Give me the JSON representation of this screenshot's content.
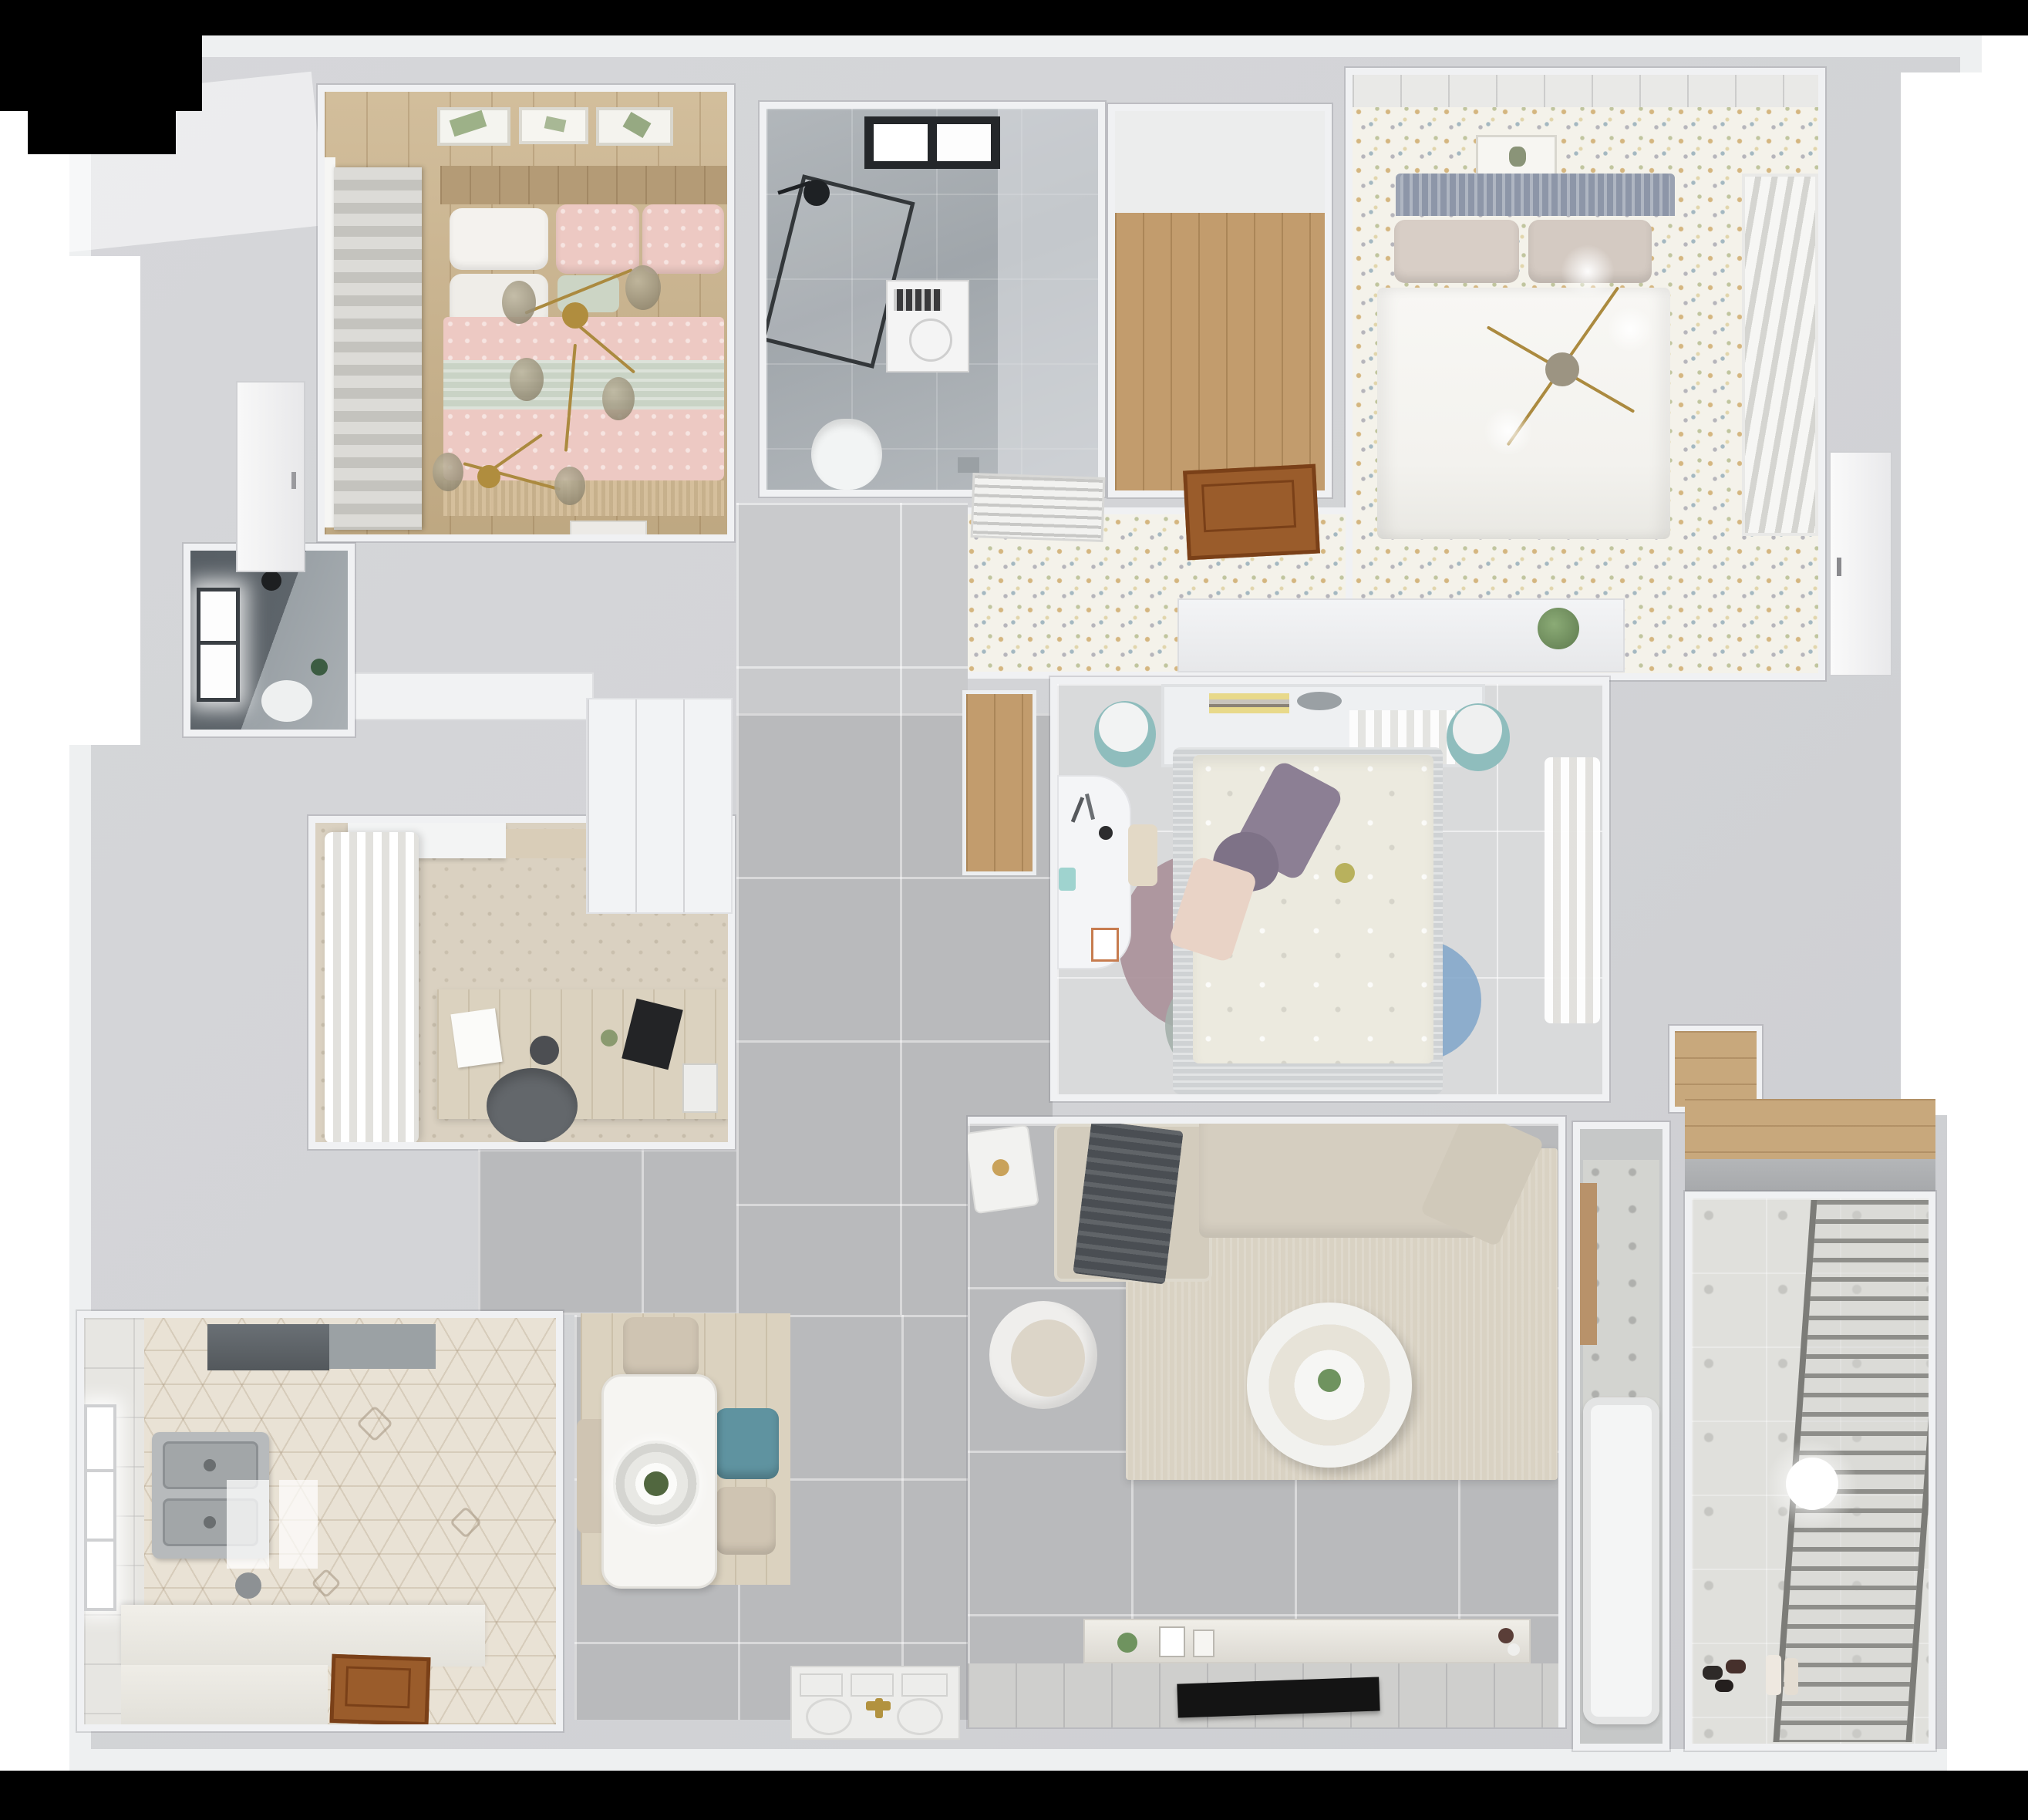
{
  "scene": {
    "type": "3d-floorplan-render",
    "view": "top-down dollhouse perspective",
    "content": "two-bedroom-plus-master apartment interior render",
    "background_color": "#ffffff",
    "frame_color": "#000000"
  },
  "palette": {
    "wall": "#d4d5d8",
    "wall_top": "#eef0f1",
    "hall_tile": "#b9babc",
    "soft_tile": "#d9dadb",
    "speckle_floor": "#f4f2ea",
    "light_wood": "#ccb58e",
    "closet_wood": "#c29c6d",
    "marble_gray": "#aab0b4",
    "dark_bath": "#5d646a",
    "hex_tile": "#e9e2d5",
    "pink_bedding": "#edc9c3",
    "sage_blanket": "#c9d3c5",
    "teal_chair": "#5f93a0",
    "teal_stool": "#8fbdbd",
    "purple_pillow": "#8c7f94",
    "rug_blue": "#7fa5c9",
    "rug_mauve": "#a98f98",
    "rug_sage": "#a4b0ab",
    "sofa_beige": "#d3ccbd",
    "living_rug": "#d9d2c3",
    "tv_black": "#141414",
    "wood_door": "#9a5c2b",
    "gold_accent": "#ab8a3f",
    "plant_green": "#6f935f"
  },
  "rooms": [
    {
      "id": "bedroom-pink",
      "floor": "light wood planks",
      "furniture": [
        "roman-shade",
        "three-wall-art-frames",
        "double-bed",
        "white-pillows",
        "pink-patterned-duvet",
        "sage-throw-band",
        "gold-branch-chandelier",
        "white-bench"
      ]
    },
    {
      "id": "bathroom-main",
      "floor": "gray marble tile",
      "furniture": [
        "black-framed-skylight",
        "walk-in-shower-glass",
        "shower-head",
        "washing-machine",
        "toilet",
        "floor-drain"
      ]
    },
    {
      "id": "entry-closet-niche",
      "floor": "warm wood planks",
      "furniture": []
    },
    {
      "id": "bedroom-master",
      "floor": "speckled terrazzo-style floor",
      "furniture": [
        "ceiling-trim",
        "wall-art",
        "rattan-headboard",
        "double-bed-white-duvet",
        "beige-pillows",
        "gold-cross-chandelier",
        "louvered-wardrobe"
      ]
    },
    {
      "id": "master-corridor",
      "floor": "speckled terrazzo-style floor",
      "furniture": [
        "ac-vent-grille",
        "open-wood-door",
        "low-white-cabinet",
        "potted-plant"
      ]
    },
    {
      "id": "hallway",
      "floor": "large gray tile",
      "furniture": [
        "white-wardrobe"
      ]
    },
    {
      "id": "bedroom-second",
      "floor": "pale gray tile",
      "furniture": [
        "wood-floor-niche",
        "headboard-shelf-with-books",
        "two-teal-stools",
        "double-bed-floral-duvet",
        "purple-pillows",
        "white-desk",
        "round-layered-rug",
        "sheer-curtains"
      ]
    },
    {
      "id": "living-room",
      "floor": "large gray tile",
      "furniture": [
        "l-shaped-beige-sofa",
        "dark-throw-blanket",
        "area-rug",
        "round-white-coffee-table",
        "armchair",
        "side-table",
        "tv-console",
        "flat-tv"
      ]
    },
    {
      "id": "study",
      "floor": "beige patterned rug",
      "furniture": [
        "white-cornice-cabinet",
        "wavy-white-curtains",
        "wood-desk",
        "laptop",
        "paper-sheets",
        "gray-desk-chair"
      ]
    },
    {
      "id": "bathroom-dark",
      "floor": "dark gray tile",
      "furniture": [
        "bright-window",
        "black-pendant-lamp",
        "toilet",
        "plant"
      ]
    },
    {
      "id": "kitchen",
      "floor": "hexagonal patterned tile",
      "furniture": [
        "range-hood",
        "cooktop-counter",
        "double-stainless-sink",
        "l-shaped-white-counter",
        "wood-door-panel",
        "window",
        "light-reflections"
      ]
    },
    {
      "id": "dining-area",
      "floor": "pale wood mat over gray tile",
      "furniture": [
        "white-rect-table",
        "ring-pendant-lamp",
        "plant-centerpiece",
        "three-beige-chairs",
        "teal-chair"
      ]
    },
    {
      "id": "balcony-laundry",
      "floor": "patterned ceramic tile",
      "furniture": [
        "drying-rack",
        "ceiling-lamp",
        "shoes",
        "bottles",
        "overhead-wood-shelf"
      ]
    },
    {
      "id": "bathroom-tub",
      "floor": "gray tile with patterned band",
      "furniture": [
        "bathtub",
        "wood-towel-rail"
      ]
    },
    {
      "id": "storage-niche",
      "floor": "wood",
      "furniture": []
    }
  ],
  "fixtures": [
    {
      "id": "front-door-mat",
      "desc": "white paneled entry door lying in plan with gold handle"
    },
    {
      "id": "white-door-left",
      "desc": "white door leaf near small bathroom"
    },
    {
      "id": "white-door-master",
      "desc": "white door leaf on master bedroom right wall"
    }
  ]
}
